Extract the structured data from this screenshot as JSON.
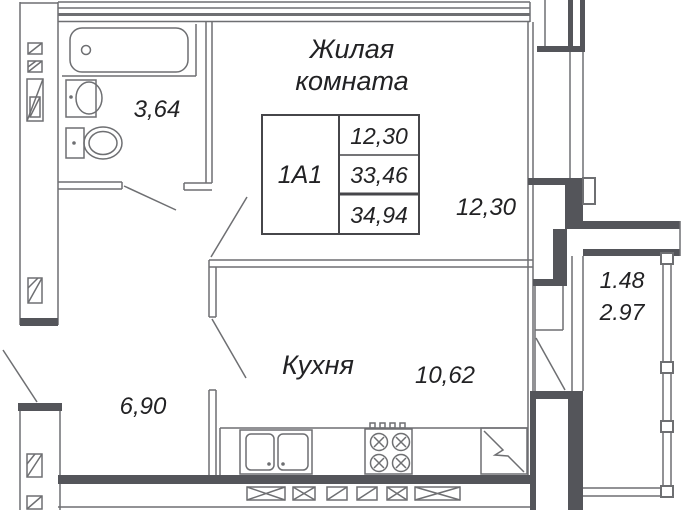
{
  "apartment": {
    "id": "1А1",
    "living_area": "12,30",
    "total_area": "33,46",
    "total_area_with_balcony": "34,94"
  },
  "rooms": {
    "living": {
      "title_line1": "Жилая",
      "title_line2": "комната",
      "area": "12,30"
    },
    "bathroom": {
      "area": "3,64"
    },
    "kitchen": {
      "name": "Кухня",
      "area": "10,62"
    },
    "hallway": {
      "area": "6,90"
    },
    "balcony": {
      "area_coefficient": "1.48",
      "area_full": "2.97"
    }
  },
  "colors": {
    "background": "#ffffff",
    "wall_dark": "#54555a",
    "line": "#6e6f72",
    "table_line": "#46464a",
    "text": "#222224"
  }
}
